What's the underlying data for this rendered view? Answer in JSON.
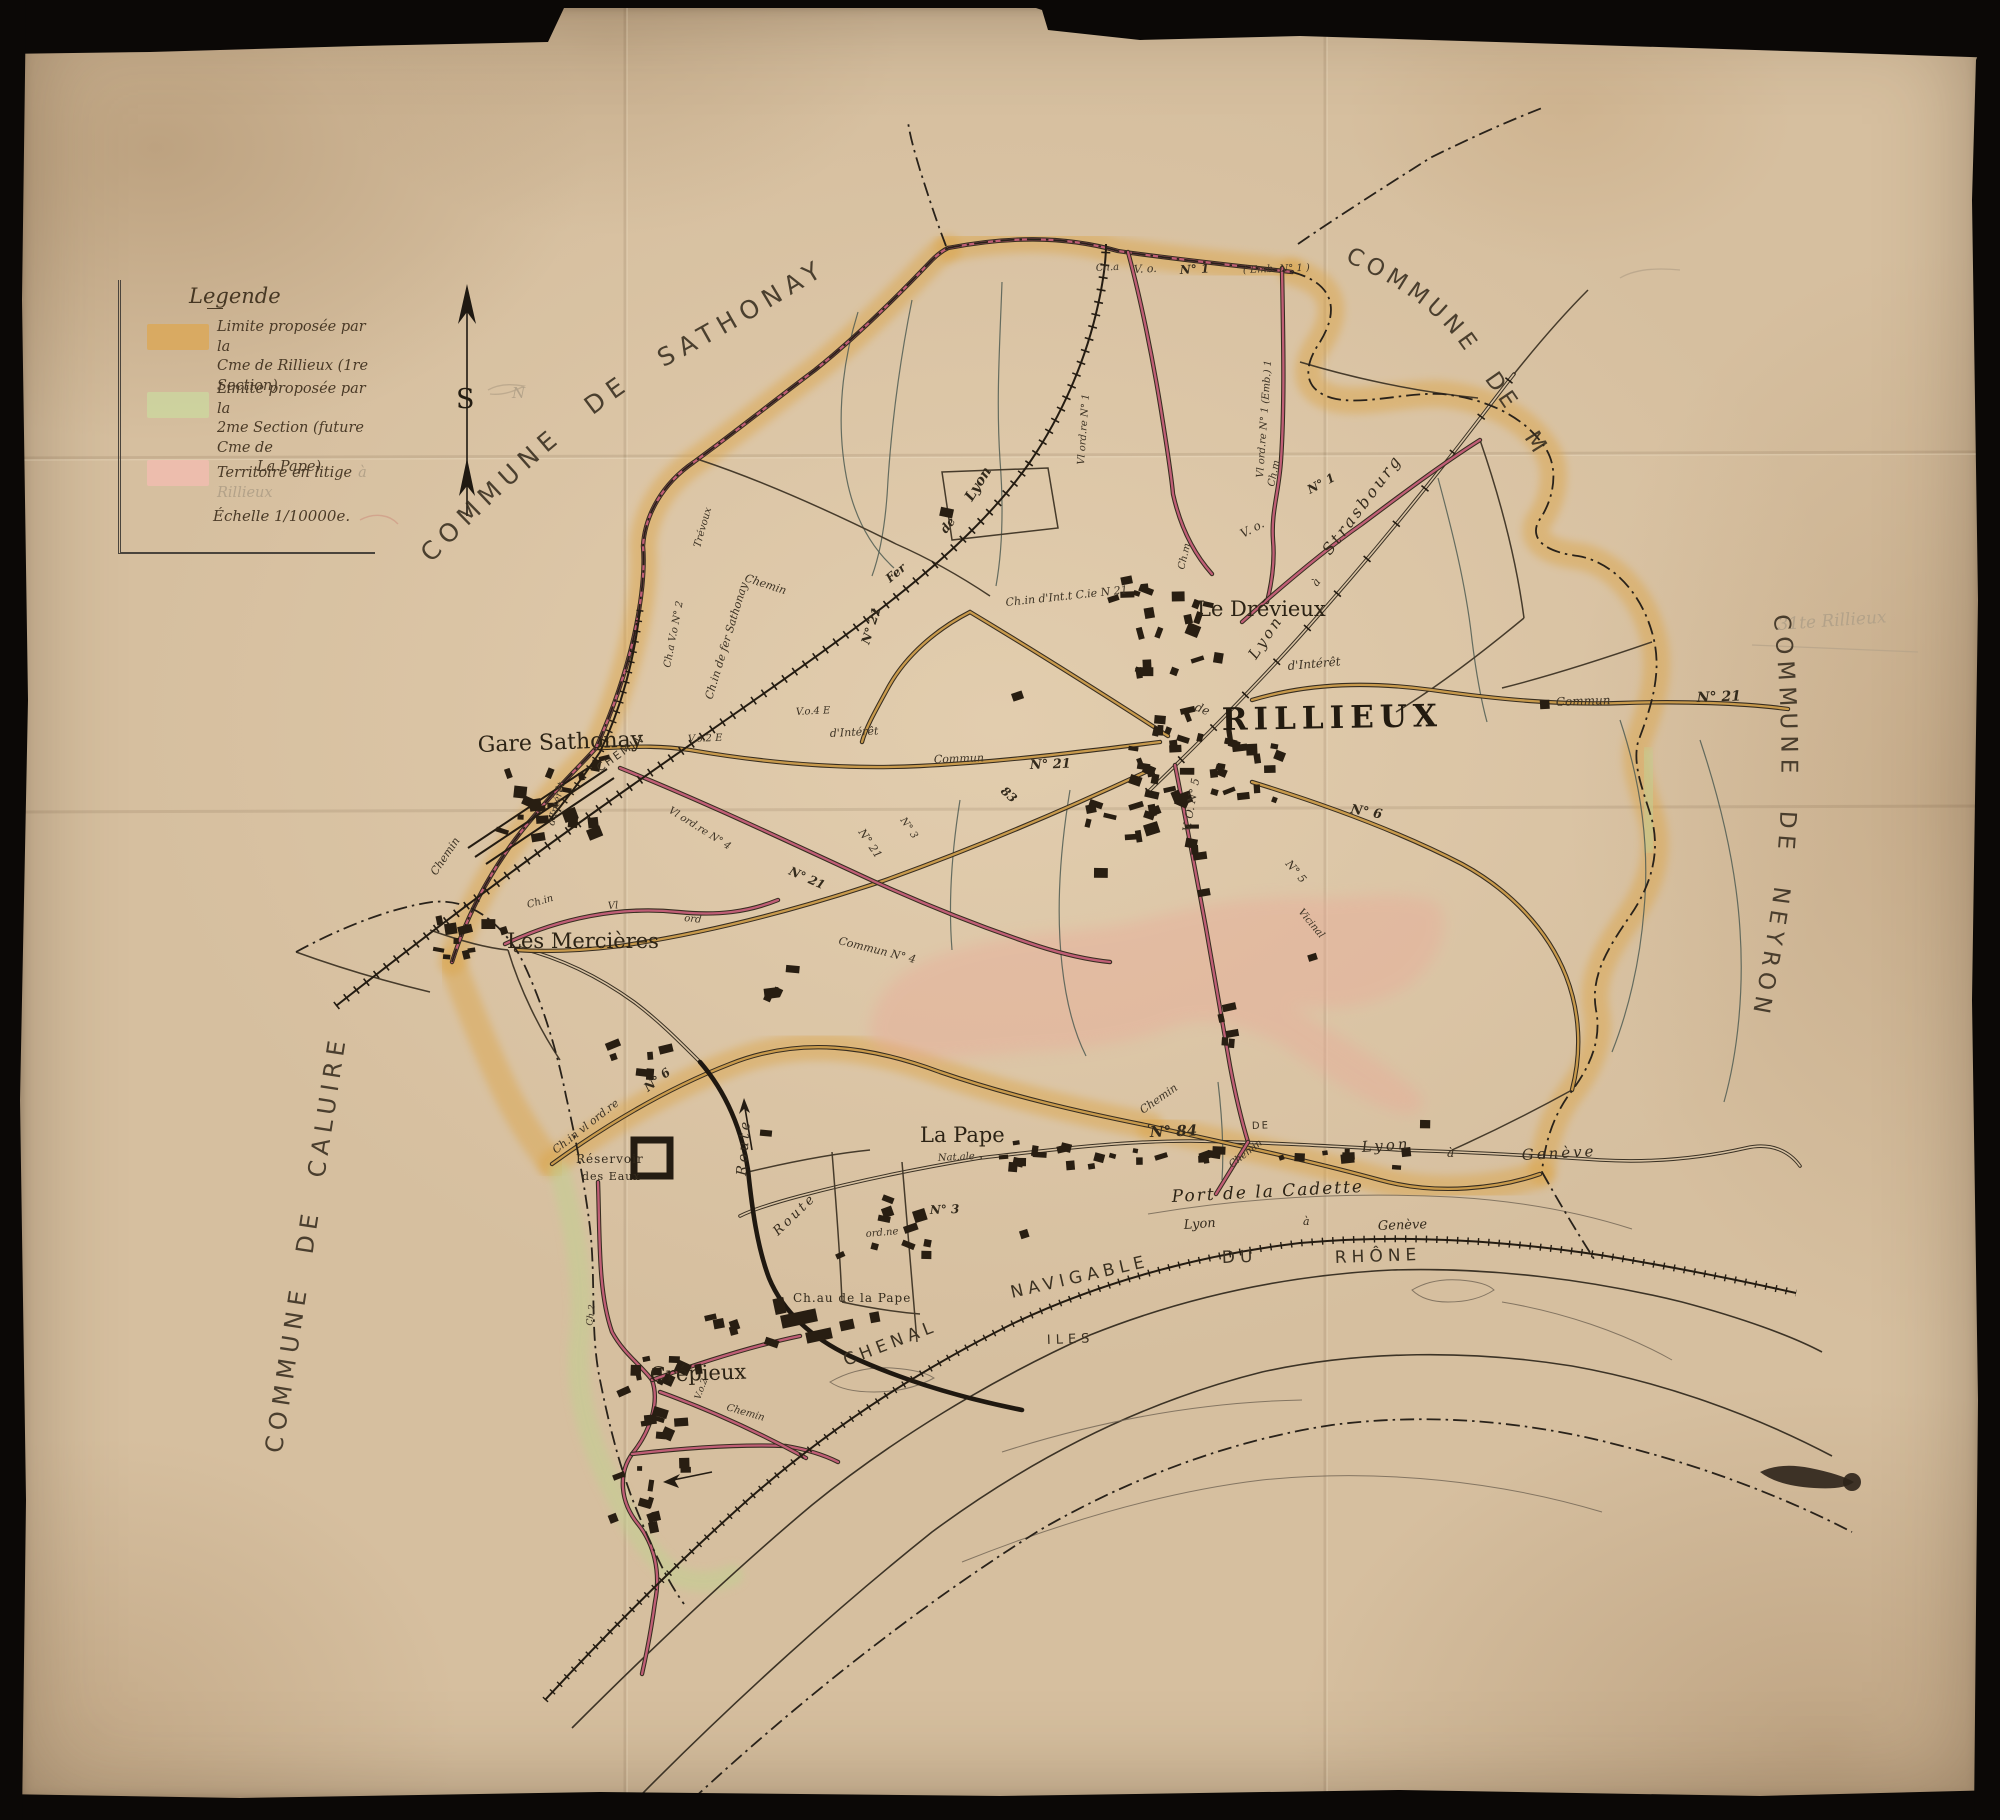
{
  "document": {
    "type": "Carte ancienne manuscrite",
    "subject": "Commune de Rillieux — limites proposées"
  },
  "colors": {
    "paper": "#d6bf9f",
    "band_orange": "#dca755",
    "band_green": "#ccd79f",
    "band_pink": "#f2bdb0",
    "road_pink": "#c05e76",
    "road_tan": "#c89a4c",
    "ink": "#2c2315",
    "pencil": "#b3a289"
  },
  "legend": {
    "title": "Legende",
    "items": [
      {
        "swatch": "#dca755",
        "lines": [
          "Limite proposée par la",
          "Cme de Rillieux (1re Section)"
        ]
      },
      {
        "swatch": "#ccd79f",
        "lines": [
          "Limite proposée par la",
          "2me Section (future Cme de",
          "La Pape)"
        ]
      },
      {
        "swatch": "#f2bdb0",
        "lines": [
          "Territoire en litige"
        ],
        "pencil": "à Rillieux"
      }
    ],
    "scale": "Échelle 1/10000e."
  },
  "compass": {
    "letter": "S",
    "pencil_note": "N"
  },
  "communes": [
    {
      "id": "sathonay",
      "name": "COMMUNE DE SATHONAY"
    },
    {
      "id": "miribel",
      "name": "COMMUNE DE MIRIBEL"
    },
    {
      "id": "neyron",
      "name": "COMMUNE DE NEYRON"
    },
    {
      "id": "caluire",
      "name": "COMMUNE DE CALUIRE"
    }
  ],
  "labels": [
    {
      "id": "label-gare-sathonay",
      "text": "Gare Sathonay",
      "x": 478,
      "y": 752,
      "rot": -2,
      "size": 22,
      "cls": "place"
    },
    {
      "id": "label-les-mercieres",
      "text": "Les Mercières",
      "x": 507,
      "y": 948,
      "rot": 0,
      "size": 21,
      "cls": "place"
    },
    {
      "id": "label-le-drevieux",
      "text": "Le Drévieux",
      "x": 1197,
      "y": 616,
      "rot": 0,
      "size": 21,
      "cls": "place"
    },
    {
      "id": "label-rillieux",
      "text": "RILLIEUX",
      "x": 1222,
      "y": 730,
      "rot": -1,
      "size": 31,
      "cls": "town"
    },
    {
      "id": "label-la-pape",
      "text": "La Pape",
      "x": 920,
      "y": 1142,
      "rot": 0,
      "size": 21,
      "cls": "place"
    },
    {
      "id": "label-crepieux",
      "text": "Crépieux",
      "x": 650,
      "y": 1382,
      "rot": -2,
      "size": 21,
      "cls": "place"
    },
    {
      "id": "label-chateau-la-pape",
      "text": "Ch.au de la Pape",
      "x": 793,
      "y": 1302,
      "rot": 0,
      "size": 12,
      "cls": "smallcaps"
    },
    {
      "id": "label-port-cadette",
      "text": "Port de la Cadette",
      "x": 1172,
      "y": 1202,
      "rot": -3,
      "size": 17,
      "cls": "placeIt"
    },
    {
      "id": "label-reservoir-1",
      "text": "Réservoir",
      "x": 576,
      "y": 1163,
      "rot": 0,
      "size": 12,
      "cls": "smallcaps"
    },
    {
      "id": "label-reservoir-2",
      "text": "des Eaux",
      "x": 582,
      "y": 1180,
      "rot": 0,
      "size": 11,
      "cls": "smallcaps"
    },
    {
      "id": "label-iles",
      "text": "ILES",
      "x": 1047,
      "y": 1344,
      "rot": -2,
      "size": 13,
      "cls": "capsSp"
    },
    {
      "id": "label-chenal",
      "text": "CHENAL",
      "x": 846,
      "y": 1366,
      "rot": -21,
      "size": 17,
      "cls": "capsSp"
    },
    {
      "id": "label-navigable",
      "text": "NAVIGABLE",
      "x": 1012,
      "y": 1298,
      "rot": -13,
      "size": 17,
      "cls": "capsSp"
    },
    {
      "id": "label-du",
      "text": "DU",
      "x": 1222,
      "y": 1263,
      "rot": -2,
      "size": 17,
      "cls": "capsSp"
    },
    {
      "id": "label-rhone",
      "text": "RHÔNE",
      "x": 1335,
      "y": 1263,
      "rot": -2,
      "size": 17,
      "cls": "capsSp"
    },
    {
      "id": "label-rail-lyon",
      "text": "Lyon",
      "x": 1184,
      "y": 1229,
      "rot": -4,
      "size": 13,
      "cls": "script"
    },
    {
      "id": "label-rail-a",
      "text": "à",
      "x": 1303,
      "y": 1225,
      "rot": 0,
      "size": 11,
      "cls": "script"
    },
    {
      "id": "label-rail-geneve",
      "text": "Genève",
      "x": 1378,
      "y": 1230,
      "rot": -2,
      "size": 13,
      "cls": "script"
    },
    {
      "id": "label-road-lyon",
      "text": "Lyon",
      "x": 1362,
      "y": 1152,
      "rot": -4,
      "size": 15,
      "cls": "scriptSp"
    },
    {
      "id": "label-road-a",
      "text": "à",
      "x": 1447,
      "y": 1157,
      "rot": 0,
      "size": 12,
      "cls": "script"
    },
    {
      "id": "label-road-geneve",
      "text": "Genève",
      "x": 1522,
      "y": 1160,
      "rot": -3,
      "size": 15,
      "cls": "scriptSp"
    },
    {
      "id": "label-n84",
      "text": "N° 84",
      "x": 1150,
      "y": 1137,
      "rot": -2,
      "size": 15,
      "cls": "roadB"
    },
    {
      "id": "label-chemin-84",
      "text": "Chemin",
      "x": 1143,
      "y": 1114,
      "rot": -35,
      "size": 11,
      "cls": "road"
    },
    {
      "id": "label-de-84",
      "text": "DE",
      "x": 1252,
      "y": 1129,
      "rot": -2,
      "size": 10,
      "cls": "capsSm"
    },
    {
      "id": "label-chemin-84b",
      "text": "Chemin",
      "x": 1232,
      "y": 1168,
      "rot": -38,
      "size": 10,
      "cls": "road"
    },
    {
      "id": "label-strasbourg",
      "text": "Strasbourg",
      "x": 1330,
      "y": 556,
      "rot": -53,
      "size": 16,
      "cls": "scriptSp"
    },
    {
      "id": "label-str-a",
      "text": "à",
      "x": 1317,
      "y": 587,
      "rot": -53,
      "size": 11,
      "cls": "script"
    },
    {
      "id": "label-str-lyon",
      "text": "Lyon",
      "x": 1256,
      "y": 660,
      "rot": -56,
      "size": 15,
      "cls": "scriptSp"
    },
    {
      "id": "label-dinteret-e",
      "text": "d'Intérêt",
      "x": 1288,
      "y": 670,
      "rot": -5,
      "size": 12,
      "cls": "road"
    },
    {
      "id": "label-commun-e",
      "text": "Commun",
      "x": 1556,
      "y": 706,
      "rot": -2,
      "size": 12,
      "cls": "road"
    },
    {
      "id": "label-n21-e",
      "text": "N° 21",
      "x": 1697,
      "y": 702,
      "rot": -2,
      "size": 14,
      "cls": "roadB"
    },
    {
      "id": "label-de-rlx",
      "text": "de",
      "x": 1194,
      "y": 710,
      "rot": 22,
      "size": 12,
      "cls": "road"
    },
    {
      "id": "label-vo-n5",
      "text": "V. O. N° 5",
      "x": 1190,
      "y": 832,
      "rot": -80,
      "size": 11,
      "cls": "road"
    },
    {
      "id": "label-n6-e",
      "text": "N° 6",
      "x": 1350,
      "y": 813,
      "rot": 10,
      "size": 13,
      "cls": "roadB"
    },
    {
      "id": "label-vicinal",
      "text": "Vicinal",
      "x": 1298,
      "y": 912,
      "rot": 50,
      "size": 10,
      "cls": "road"
    },
    {
      "id": "label-n5-b",
      "text": "N° 5",
      "x": 1285,
      "y": 864,
      "rot": 50,
      "size": 11,
      "cls": "road"
    },
    {
      "id": "label-chm-vlord6",
      "text": "Ch.in vl ord.re",
      "x": 556,
      "y": 1154,
      "rot": -38,
      "size": 11,
      "cls": "road"
    },
    {
      "id": "label-n6-s",
      "text": "N° 6",
      "x": 648,
      "y": 1092,
      "rot": -38,
      "size": 12,
      "cls": "roadB"
    },
    {
      "id": "label-cha-top",
      "text": "Ch.a",
      "x": 1096,
      "y": 271,
      "rot": -3,
      "size": 10,
      "cls": "road"
    },
    {
      "id": "label-vo-top",
      "text": "V. o.",
      "x": 1134,
      "y": 273,
      "rot": -3,
      "size": 11,
      "cls": "road"
    },
    {
      "id": "label-n1-top",
      "text": "N° 1",
      "x": 1180,
      "y": 274,
      "rot": -3,
      "size": 12,
      "cls": "roadB"
    },
    {
      "id": "label-emb-top",
      "text": "( Emb. N° 1 )",
      "x": 1243,
      "y": 273,
      "rot": -2,
      "size": 10,
      "cls": "road"
    },
    {
      "id": "label-vlord-emb",
      "text": "Vl ord.re N° 1 (Emb.) 1",
      "x": 1263,
      "y": 478,
      "rot": -86,
      "size": 10,
      "cls": "road"
    },
    {
      "id": "label-vlord-n1w",
      "text": "Vl ord.re  N° 1",
      "x": 1084,
      "y": 465,
      "rot": -86,
      "size": 10,
      "cls": "road"
    },
    {
      "id": "label-vo-drv",
      "text": "V. o.",
      "x": 1243,
      "y": 538,
      "rot": -28,
      "size": 12,
      "cls": "road"
    },
    {
      "id": "label-n1-drv",
      "text": "N° 1",
      "x": 1310,
      "y": 494,
      "rot": -28,
      "size": 12,
      "cls": "roadB"
    },
    {
      "id": "label-chm-a",
      "text": "Ch.m",
      "x": 1184,
      "y": 570,
      "rot": -76,
      "size": 10,
      "cls": "road"
    },
    {
      "id": "label-chm-b",
      "text": "Ch.m",
      "x": 1274,
      "y": 487,
      "rot": -78,
      "size": 10,
      "cls": "road"
    },
    {
      "id": "label-chvo-n2",
      "text": "Ch.a V.o N° 2",
      "x": 670,
      "y": 668,
      "rot": -79,
      "size": 10,
      "cls": "road"
    },
    {
      "id": "label-fer-sathonay",
      "text": "Ch.in de fer Sathonay",
      "x": 712,
      "y": 700,
      "rot": -73,
      "size": 11,
      "cls": "road"
    },
    {
      "id": "label-chemin-ne",
      "text": "Chemin",
      "x": 744,
      "y": 581,
      "rot": 18,
      "size": 11,
      "cls": "road"
    },
    {
      "id": "label-trevoux",
      "text": "Trévoux",
      "x": 700,
      "y": 548,
      "rot": -74,
      "size": 10,
      "cls": "road"
    },
    {
      "id": "label-fer",
      "text": "Fer",
      "x": 890,
      "y": 583,
      "rot": -40,
      "size": 12,
      "cls": "roadB"
    },
    {
      "id": "label-fer-de",
      "text": "de",
      "x": 946,
      "y": 534,
      "rot": -52,
      "size": 12,
      "cls": "roadB"
    },
    {
      "id": "label-fer-lyon",
      "text": "Lyon",
      "x": 972,
      "y": 502,
      "rot": -58,
      "size": 14,
      "cls": "roadB"
    },
    {
      "id": "label-chemin-gare",
      "text": "CHEMIN",
      "x": 600,
      "y": 772,
      "rot": -35,
      "size": 11,
      "cls": "capsSm"
    },
    {
      "id": "label-vo4e",
      "text": "V.o.4 E",
      "x": 796,
      "y": 715,
      "rot": -3,
      "size": 10,
      "cls": "road"
    },
    {
      "id": "label-vo2e",
      "text": "V.o.2 E",
      "x": 688,
      "y": 742,
      "rot": -2,
      "size": 10,
      "cls": "road"
    },
    {
      "id": "label-dinteret-w",
      "text": "d'Intérêt",
      "x": 830,
      "y": 737,
      "rot": -3,
      "size": 11,
      "cls": "road"
    },
    {
      "id": "label-commun-w",
      "text": "Commun",
      "x": 934,
      "y": 763,
      "rot": -2,
      "size": 11,
      "cls": "road"
    },
    {
      "id": "label-n21-w",
      "text": "N° 21",
      "x": 1030,
      "y": 769,
      "rot": -2,
      "size": 13,
      "cls": "roadB"
    },
    {
      "id": "label-chint-nw",
      "text": "Ch.in d'Int.t C.ie N 21",
      "x": 1006,
      "y": 606,
      "rot": -6,
      "size": 11,
      "cls": "road"
    },
    {
      "id": "label-n21-v",
      "text": "N° 21",
      "x": 869,
      "y": 645,
      "rot": -72,
      "size": 12,
      "cls": "roadB"
    },
    {
      "id": "label-n21-sw",
      "text": "N° 21",
      "x": 788,
      "y": 874,
      "rot": 24,
      "size": 12,
      "cls": "roadB"
    },
    {
      "id": "label-n83",
      "text": "83",
      "x": 1000,
      "y": 792,
      "rot": 42,
      "size": 12,
      "cls": "roadB"
    },
    {
      "id": "label-n21-d",
      "text": "N° 21",
      "x": 858,
      "y": 832,
      "rot": 56,
      "size": 11,
      "cls": "road"
    },
    {
      "id": "label-n3-d",
      "text": "N° 3",
      "x": 900,
      "y": 820,
      "rot": 56,
      "size": 10,
      "cls": "road"
    },
    {
      "id": "label-vlord-n4",
      "text": "Vl ord.re  N° 4",
      "x": 668,
      "y": 812,
      "rot": 32,
      "size": 10,
      "cls": "road"
    },
    {
      "id": "label-commun-n4",
      "text": "Commun  N° 4",
      "x": 838,
      "y": 944,
      "rot": 14,
      "size": 11,
      "cls": "road"
    },
    {
      "id": "label-chin-lm",
      "text": "Ch.in",
      "x": 528,
      "y": 908,
      "rot": -16,
      "size": 10,
      "cls": "road"
    },
    {
      "id": "label-vl-lm",
      "text": "Vl",
      "x": 608,
      "y": 909,
      "rot": -4,
      "size": 10,
      "cls": "road"
    },
    {
      "id": "label-ord-lm",
      "text": "ord",
      "x": 684,
      "y": 921,
      "rot": 6,
      "size": 10,
      "cls": "road"
    },
    {
      "id": "label-dint-v",
      "text": "d'Intérêt",
      "x": 554,
      "y": 826,
      "rot": -76,
      "size": 10,
      "cls": "road"
    },
    {
      "id": "label-chemin-w",
      "text": "Chemin",
      "x": 436,
      "y": 876,
      "rot": -56,
      "size": 11,
      "cls": "road"
    },
    {
      "id": "label-route-1",
      "text": "Route",
      "x": 746,
      "y": 1176,
      "rot": -86,
      "size": 14,
      "cls": "scriptSp"
    },
    {
      "id": "label-route-2",
      "text": "Route",
      "x": 778,
      "y": 1236,
      "rot": -44,
      "size": 13,
      "cls": "scriptSp"
    },
    {
      "id": "label-nationale",
      "text": "Nat.ale",
      "x": 938,
      "y": 1161,
      "rot": -3,
      "size": 10,
      "cls": "road"
    },
    {
      "id": "label-n3-lp",
      "text": "N° 3",
      "x": 930,
      "y": 1214,
      "rot": -2,
      "size": 12,
      "cls": "roadB"
    },
    {
      "id": "label-ord-lp",
      "text": "ord.ne",
      "x": 866,
      "y": 1237,
      "rot": -5,
      "size": 10,
      "cls": "road"
    },
    {
      "id": "label-chemin-cr",
      "text": "Chemin",
      "x": 726,
      "y": 1410,
      "rot": 16,
      "size": 10,
      "cls": "road"
    },
    {
      "id": "label-vo2-cr",
      "text": "V.o.2",
      "x": 700,
      "y": 1400,
      "rot": -70,
      "size": 9,
      "cls": "road"
    },
    {
      "id": "label-ch2-cr",
      "text": "Ch.2",
      "x": 592,
      "y": 1326,
      "rot": -82,
      "size": 9,
      "cls": "road"
    },
    {
      "id": "pencil-annotation",
      "text": "31te Rillieux",
      "x": 1778,
      "y": 630,
      "rot": -4,
      "size": 17,
      "cls": "pencil"
    },
    {
      "id": "pencil-north-note",
      "text": "N",
      "x": 512,
      "y": 398,
      "rot": 0,
      "size": 15,
      "cls": "pencil"
    },
    {
      "id": "compass-letter",
      "text": "S",
      "x": 456,
      "y": 408,
      "rot": 0,
      "size": 27,
      "cls": "compassS"
    }
  ]
}
